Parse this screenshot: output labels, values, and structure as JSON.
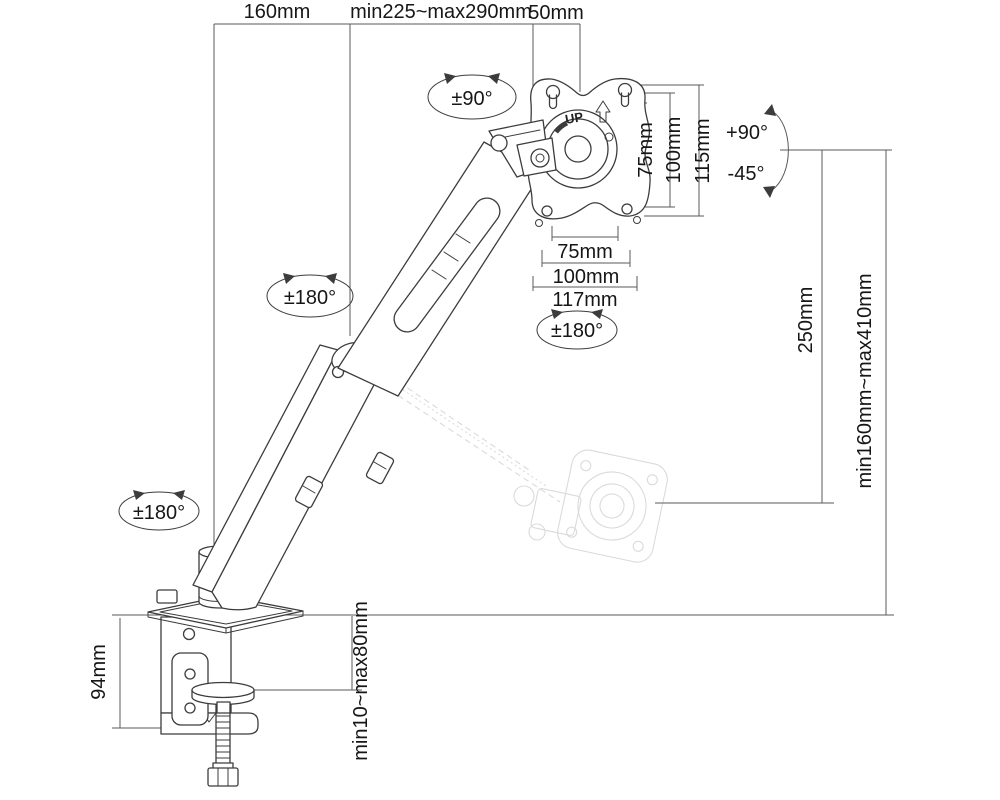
{
  "meta": {
    "description": "Technical line drawing of a gas-spring desk-mount monitor arm with dimensions"
  },
  "colors": {
    "background": "#ffffff",
    "line_art": "#3c3c3c",
    "dimension_lines": "#5a5a5a",
    "label_text": "#161616",
    "ghost_arm": "#8f8f8f"
  },
  "labels": {
    "top_base": "160mm",
    "top_reach": "min225~max290mm",
    "top_head": "50mm",
    "vesa_h75": "75mm",
    "vesa_h100": "100mm",
    "vesa_h115": "115mm",
    "vesa_w75": "75mm",
    "vesa_w100": "100mm",
    "vesa_w117": "117mm",
    "vesa_up": "UP",
    "right_drop": "250mm",
    "right_range": "min160mm~max410mm",
    "clamp_height": "94mm",
    "desk_thickness": "min10~max80mm",
    "rot_head": "±90°",
    "rot_elbow": "±180°",
    "rot_vesa": "±180°",
    "rot_base": "±180°",
    "tilt_up": "+90°",
    "tilt_down": "-45°"
  }
}
